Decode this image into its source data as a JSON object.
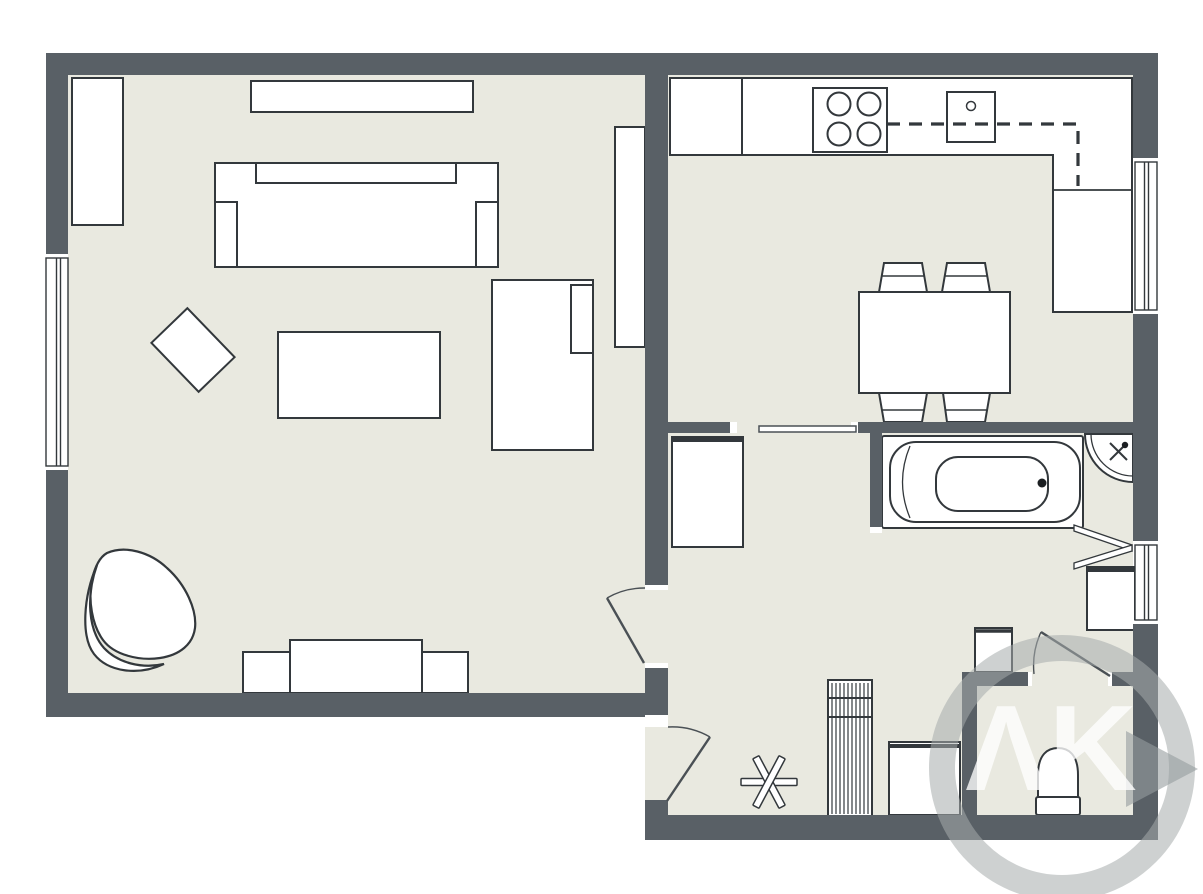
{
  "diagram": {
    "type": "floor-plan",
    "watermark": {
      "text": "ΛK"
    },
    "colors": {
      "wall": "#596066",
      "floor": "#e9e9e0",
      "furniture_fill": "#ffffff",
      "furniture_outline": "#33383c",
      "background": "#ffffff",
      "watermark_gray": "#a6acac"
    },
    "rooms": [
      {
        "name": "living-room"
      },
      {
        "name": "kitchen"
      },
      {
        "name": "hallway"
      },
      {
        "name": "bathroom"
      },
      {
        "name": "wc"
      }
    ],
    "furniture_icons": [
      "bookcase-icon",
      "wall-shelf-icon",
      "sofa-icon",
      "rug-icon",
      "coffee-table-icon",
      "chaise-longue-icon",
      "armchair-icon",
      "tv-stand-icon",
      "kitchen-counter-icon",
      "cooktop-icon",
      "sink-icon",
      "upper-cabinet-dashed-icon",
      "dining-table-icon",
      "dining-chair-icon",
      "sliding-door-icon",
      "wardrobe-icon",
      "radiator-icon",
      "coat-stand-icon",
      "washing-machine-icon",
      "wash-basin-icon",
      "bathtub-icon",
      "corner-shower-icon",
      "folding-door-icon",
      "toilet-icon",
      "hall-closet-icon",
      "window-icon",
      "door-swing-icon"
    ]
  }
}
